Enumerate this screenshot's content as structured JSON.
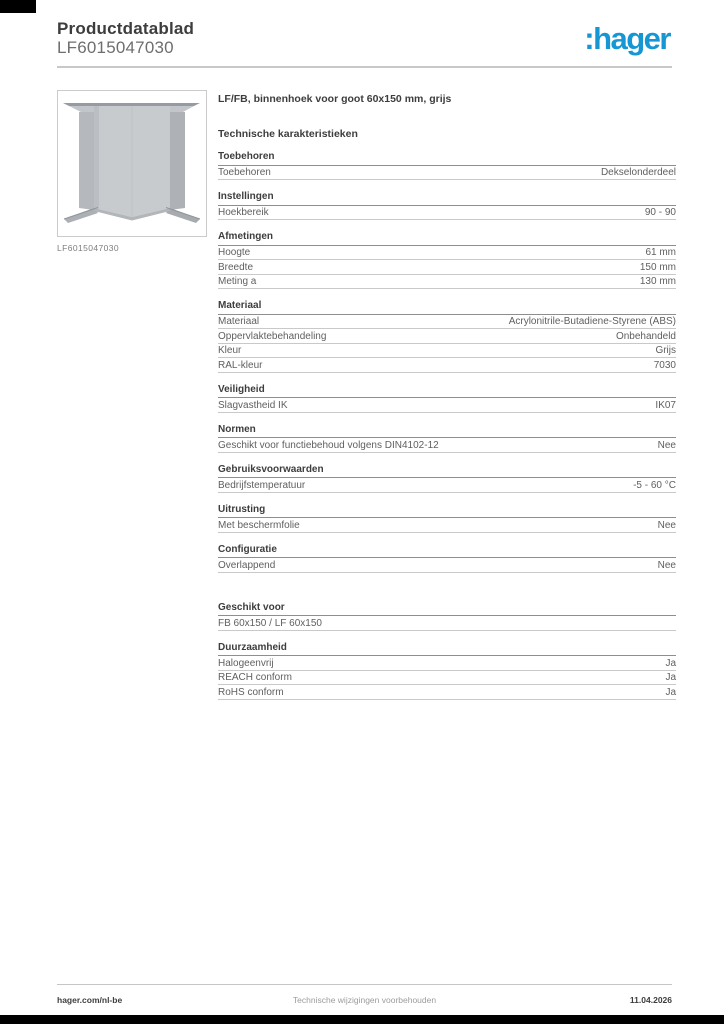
{
  "page": {
    "header": {
      "title": "Productdatablad",
      "product_id": "LF6015047030",
      "logo_text": ":hager"
    },
    "product": {
      "image_caption": "LF6015047030",
      "title": "LF/FB, binnenhoek voor goot 60x150 mm, grijs"
    },
    "specs": {
      "heading": "Technische karakteristieken",
      "sections": [
        {
          "title": "Toebehoren",
          "rows": [
            {
              "label": "Toebehoren",
              "value": "Dekselonderdeel"
            }
          ]
        },
        {
          "title": "Instellingen",
          "rows": [
            {
              "label": "Hoekbereik",
              "value": "90 - 90"
            }
          ]
        },
        {
          "title": "Afmetingen",
          "rows": [
            {
              "label": "Hoogte",
              "value": "61 mm"
            },
            {
              "label": "Breedte",
              "value": "150 mm"
            },
            {
              "label": "Meting a",
              "value": "130 mm"
            }
          ]
        },
        {
          "title": "Materiaal",
          "rows": [
            {
              "label": "Materiaal",
              "value": "Acrylonitrile-Butadiene-Styrene (ABS)"
            },
            {
              "label": "Oppervlaktebehandeling",
              "value": "Onbehandeld"
            },
            {
              "label": "Kleur",
              "value": "Grijs"
            },
            {
              "label": "RAL-kleur",
              "value": "7030"
            }
          ]
        },
        {
          "title": "Veiligheid",
          "rows": [
            {
              "label": "Slagvastheid IK",
              "value": "IK07"
            }
          ]
        },
        {
          "title": "Normen",
          "rows": [
            {
              "label": "Geschikt voor functiebehoud volgens DIN4102-12",
              "value": "Nee"
            }
          ]
        },
        {
          "title": "Gebruiksvoorwaarden",
          "rows": [
            {
              "label": "Bedrijfstemperatuur",
              "value": "-5 - 60 °C"
            }
          ]
        },
        {
          "title": "Uitrusting",
          "rows": [
            {
              "label": "Met beschermfolie",
              "value": "Nee"
            }
          ]
        },
        {
          "title": "Configuratie",
          "rows": [
            {
              "label": "Overlappend",
              "value": "Nee"
            }
          ]
        },
        {
          "title": "Geschikt voor",
          "rows": [
            {
              "label": "FB 60x150 / LF 60x150",
              "value": ""
            }
          ]
        },
        {
          "title": "Duurzaamheid",
          "rows": [
            {
              "label": "Halogeenvrij",
              "value": "Ja"
            },
            {
              "label": "REACH conform",
              "value": "Ja"
            },
            {
              "label": "RoHS conform",
              "value": "Ja"
            }
          ]
        }
      ]
    },
    "footer": {
      "website": "hager.com/nl-be",
      "disclaimer": "Technische wijzigingen voorbehouden",
      "date": "11.04.2026"
    },
    "colors": {
      "brand_blue": "#1697d4",
      "heading_text": "#3d3d3d",
      "body_text": "#5f5f5f",
      "rule_dark": "#8e8e8e",
      "rule_light": "#c9c9c9"
    }
  }
}
